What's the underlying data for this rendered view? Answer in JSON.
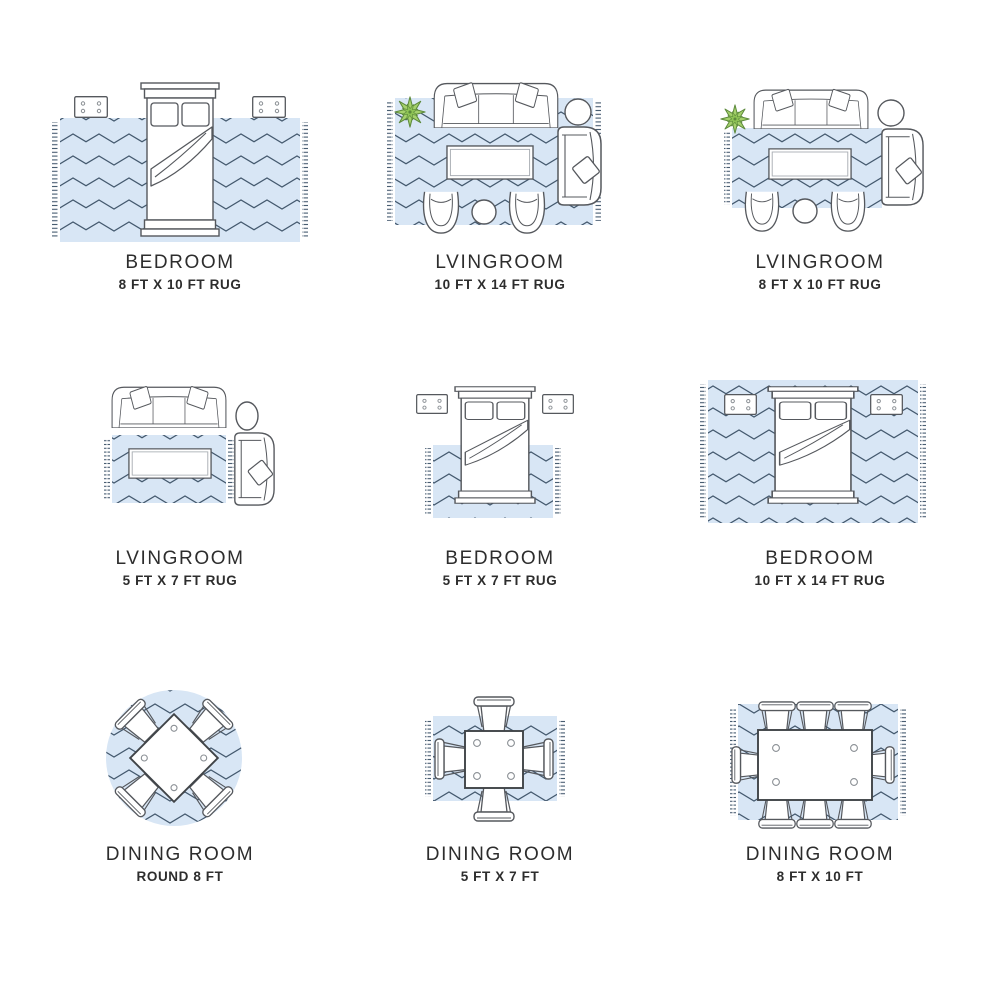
{
  "page": {
    "name": "rug size guide"
  },
  "theme": {
    "rug": "#d8e6f5",
    "pattern_line": "#44596e",
    "furniture_line": "#55585d",
    "table_line": "#404448",
    "plant_fill": "#a5d16c",
    "plant_stroke": "#5d8a3c",
    "label_color": "#2d2d2d",
    "page_bg": "#ffffff"
  },
  "rooms": [
    {
      "id": "bedroom-8x10",
      "title": "BEDROOM",
      "subtitle": "8 FT X 10 FT RUG"
    },
    {
      "id": "livingroom-10x14",
      "title": "LVINGROOM",
      "subtitle": "10 FT X 14 FT RUG"
    },
    {
      "id": "livingroom-8x10",
      "title": "LVINGROOM",
      "subtitle": "8 FT X 10 FT RUG"
    },
    {
      "id": "livingroom-5x7",
      "title": "LVINGROOM",
      "subtitle": "5 FT X 7 FT RUG"
    },
    {
      "id": "bedroom-5x7",
      "title": "BEDROOM",
      "subtitle": "5 FT X 7 FT RUG"
    },
    {
      "id": "bedroom-10x14",
      "title": "BEDROOM",
      "subtitle": "10 FT X 14 FT RUG"
    },
    {
      "id": "diningroom-round8",
      "title": "DINING ROOM",
      "subtitle": "ROUND 8 FT"
    },
    {
      "id": "diningroom-5x7",
      "title": "DINING ROOM",
      "subtitle": "5 FT X 7 FT"
    },
    {
      "id": "diningroom-8x10",
      "title": "DINING ROOM",
      "subtitle": "8 FT X 10 FT"
    }
  ]
}
